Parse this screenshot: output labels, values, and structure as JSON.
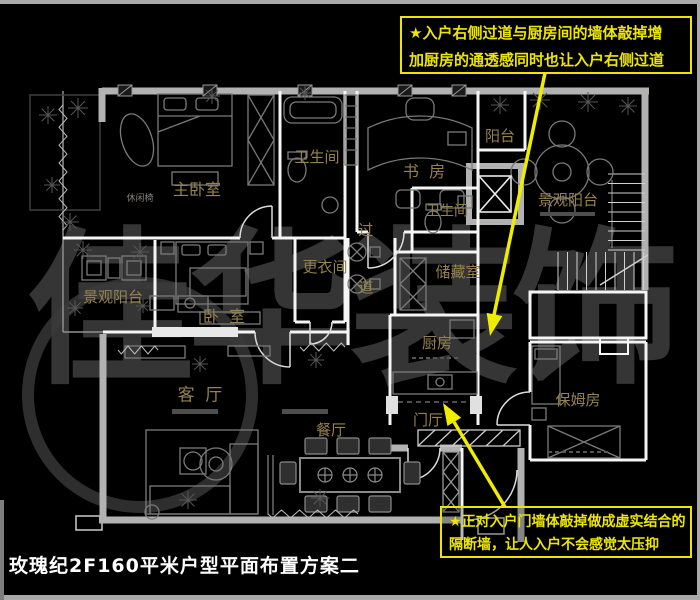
{
  "title": "玫瑰纪2F160平米户型平面布置方案二",
  "watermark": "佳华装饰",
  "annotations": {
    "top_note": {
      "lines": [
        "★入户右侧过道与厨房间的墙体敲掉增",
        "加厨房的通透感同时也让入户右侧过道"
      ]
    },
    "bottom_note": {
      "lines": [
        "★正对入户门墙体敲掉做成虚实结合的",
        "隔断墙，让人入户不会感觉太压抑"
      ]
    }
  },
  "rooms": [
    {
      "id": "master-bedroom",
      "label": "主卧室"
    },
    {
      "id": "bathroom-top",
      "label": "卫生间"
    },
    {
      "id": "study",
      "label": "书  房"
    },
    {
      "id": "balcony-top",
      "label": "阳台"
    },
    {
      "id": "view-balcony-right",
      "label": "景观阳台"
    },
    {
      "id": "bathroom-mid",
      "label": "卫生间"
    },
    {
      "id": "dressing-room",
      "label": "更衣间"
    },
    {
      "id": "corridor",
      "label": "过道"
    },
    {
      "id": "storage-room",
      "label": "储藏室"
    },
    {
      "id": "view-balcony-left",
      "label": "景观阳台"
    },
    {
      "id": "bedroom",
      "label": "卧  室"
    },
    {
      "id": "kitchen",
      "label": "厨房"
    },
    {
      "id": "living-room",
      "label": "客  厅"
    },
    {
      "id": "dining-room",
      "label": "餐厅"
    },
    {
      "id": "entry-hall",
      "label": "门厅"
    },
    {
      "id": "nanny-room",
      "label": "保姆房"
    },
    {
      "id": "leisure-chair",
      "label": "休闲椅"
    }
  ],
  "colors": {
    "annotation_yellow": "#ece600",
    "room_label_gold": "#96824e",
    "outer_wall_gray": "#b2b2b2",
    "inner_wall_white": "#f5f5f5",
    "title_white": "#ffffff",
    "watermark_gray": "#3b3b3b"
  }
}
